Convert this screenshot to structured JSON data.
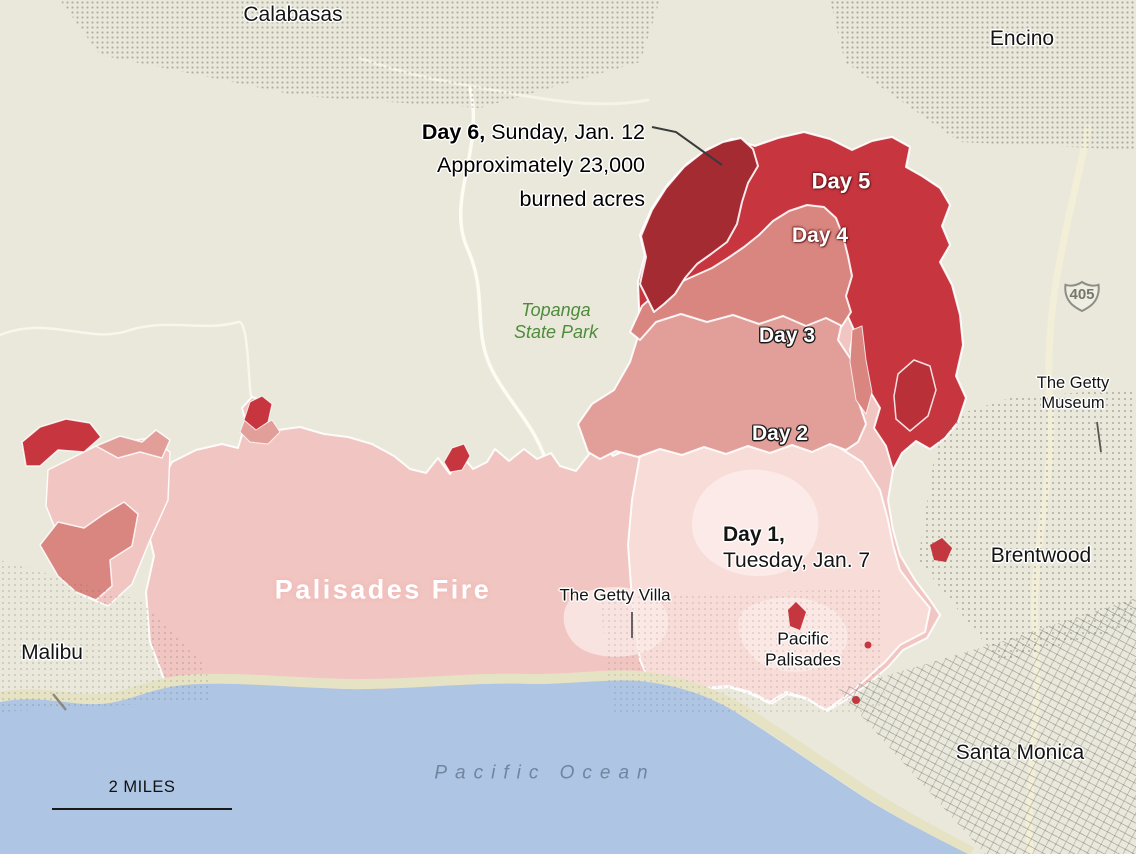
{
  "map_labels": {
    "calabasas": "Calabasas",
    "encino": "Encino",
    "malibu": "Malibu",
    "brentwood": "Brentwood",
    "santa_monica": "Santa Monica",
    "pacific_palisades_line1": "Pacific",
    "pacific_palisades_line2": "Palisades",
    "getty_villa": "The Getty Villa",
    "getty_museum_line1": "The Getty",
    "getty_museum_line2": "Museum",
    "topanga_line1": "Topanga",
    "topanga_line2": "State Park",
    "pacific_ocean": "Pacific Ocean"
  },
  "fire": {
    "name": "Palisades Fire",
    "annotation": {
      "day_label": "Day 6,",
      "date": " Sunday, Jan. 12",
      "line2": "Approximately 23,000",
      "line3": "burned acres"
    },
    "day_labels": {
      "day5": "Day 5",
      "day4": "Day 4",
      "day3": "Day 3",
      "day2": "Day 2",
      "day1_label": "Day 1,",
      "day1_date": "Tuesday, Jan. 7"
    },
    "colors": {
      "day1": "#f7dcd8",
      "day1_inner": "#fbeae7",
      "day2": "#f1c5c1",
      "day3": "#e29e99",
      "day4": "#da8680",
      "day5": "#c7363f",
      "day6": "#a52b33",
      "day6_east": "#b93039",
      "perimeter": "#ffffff"
    }
  },
  "scale_bar": {
    "label": "2 MILES"
  },
  "highway_shield": {
    "number": "405"
  },
  "base_colors": {
    "land": "#e9e8db",
    "ocean": "#aec5e3",
    "sand": "#e6e2c4",
    "road": "#fbfaf0",
    "park_text": "#4e8c3c",
    "ocean_text": "#71859f",
    "leader_line": "#3a3a3a"
  }
}
